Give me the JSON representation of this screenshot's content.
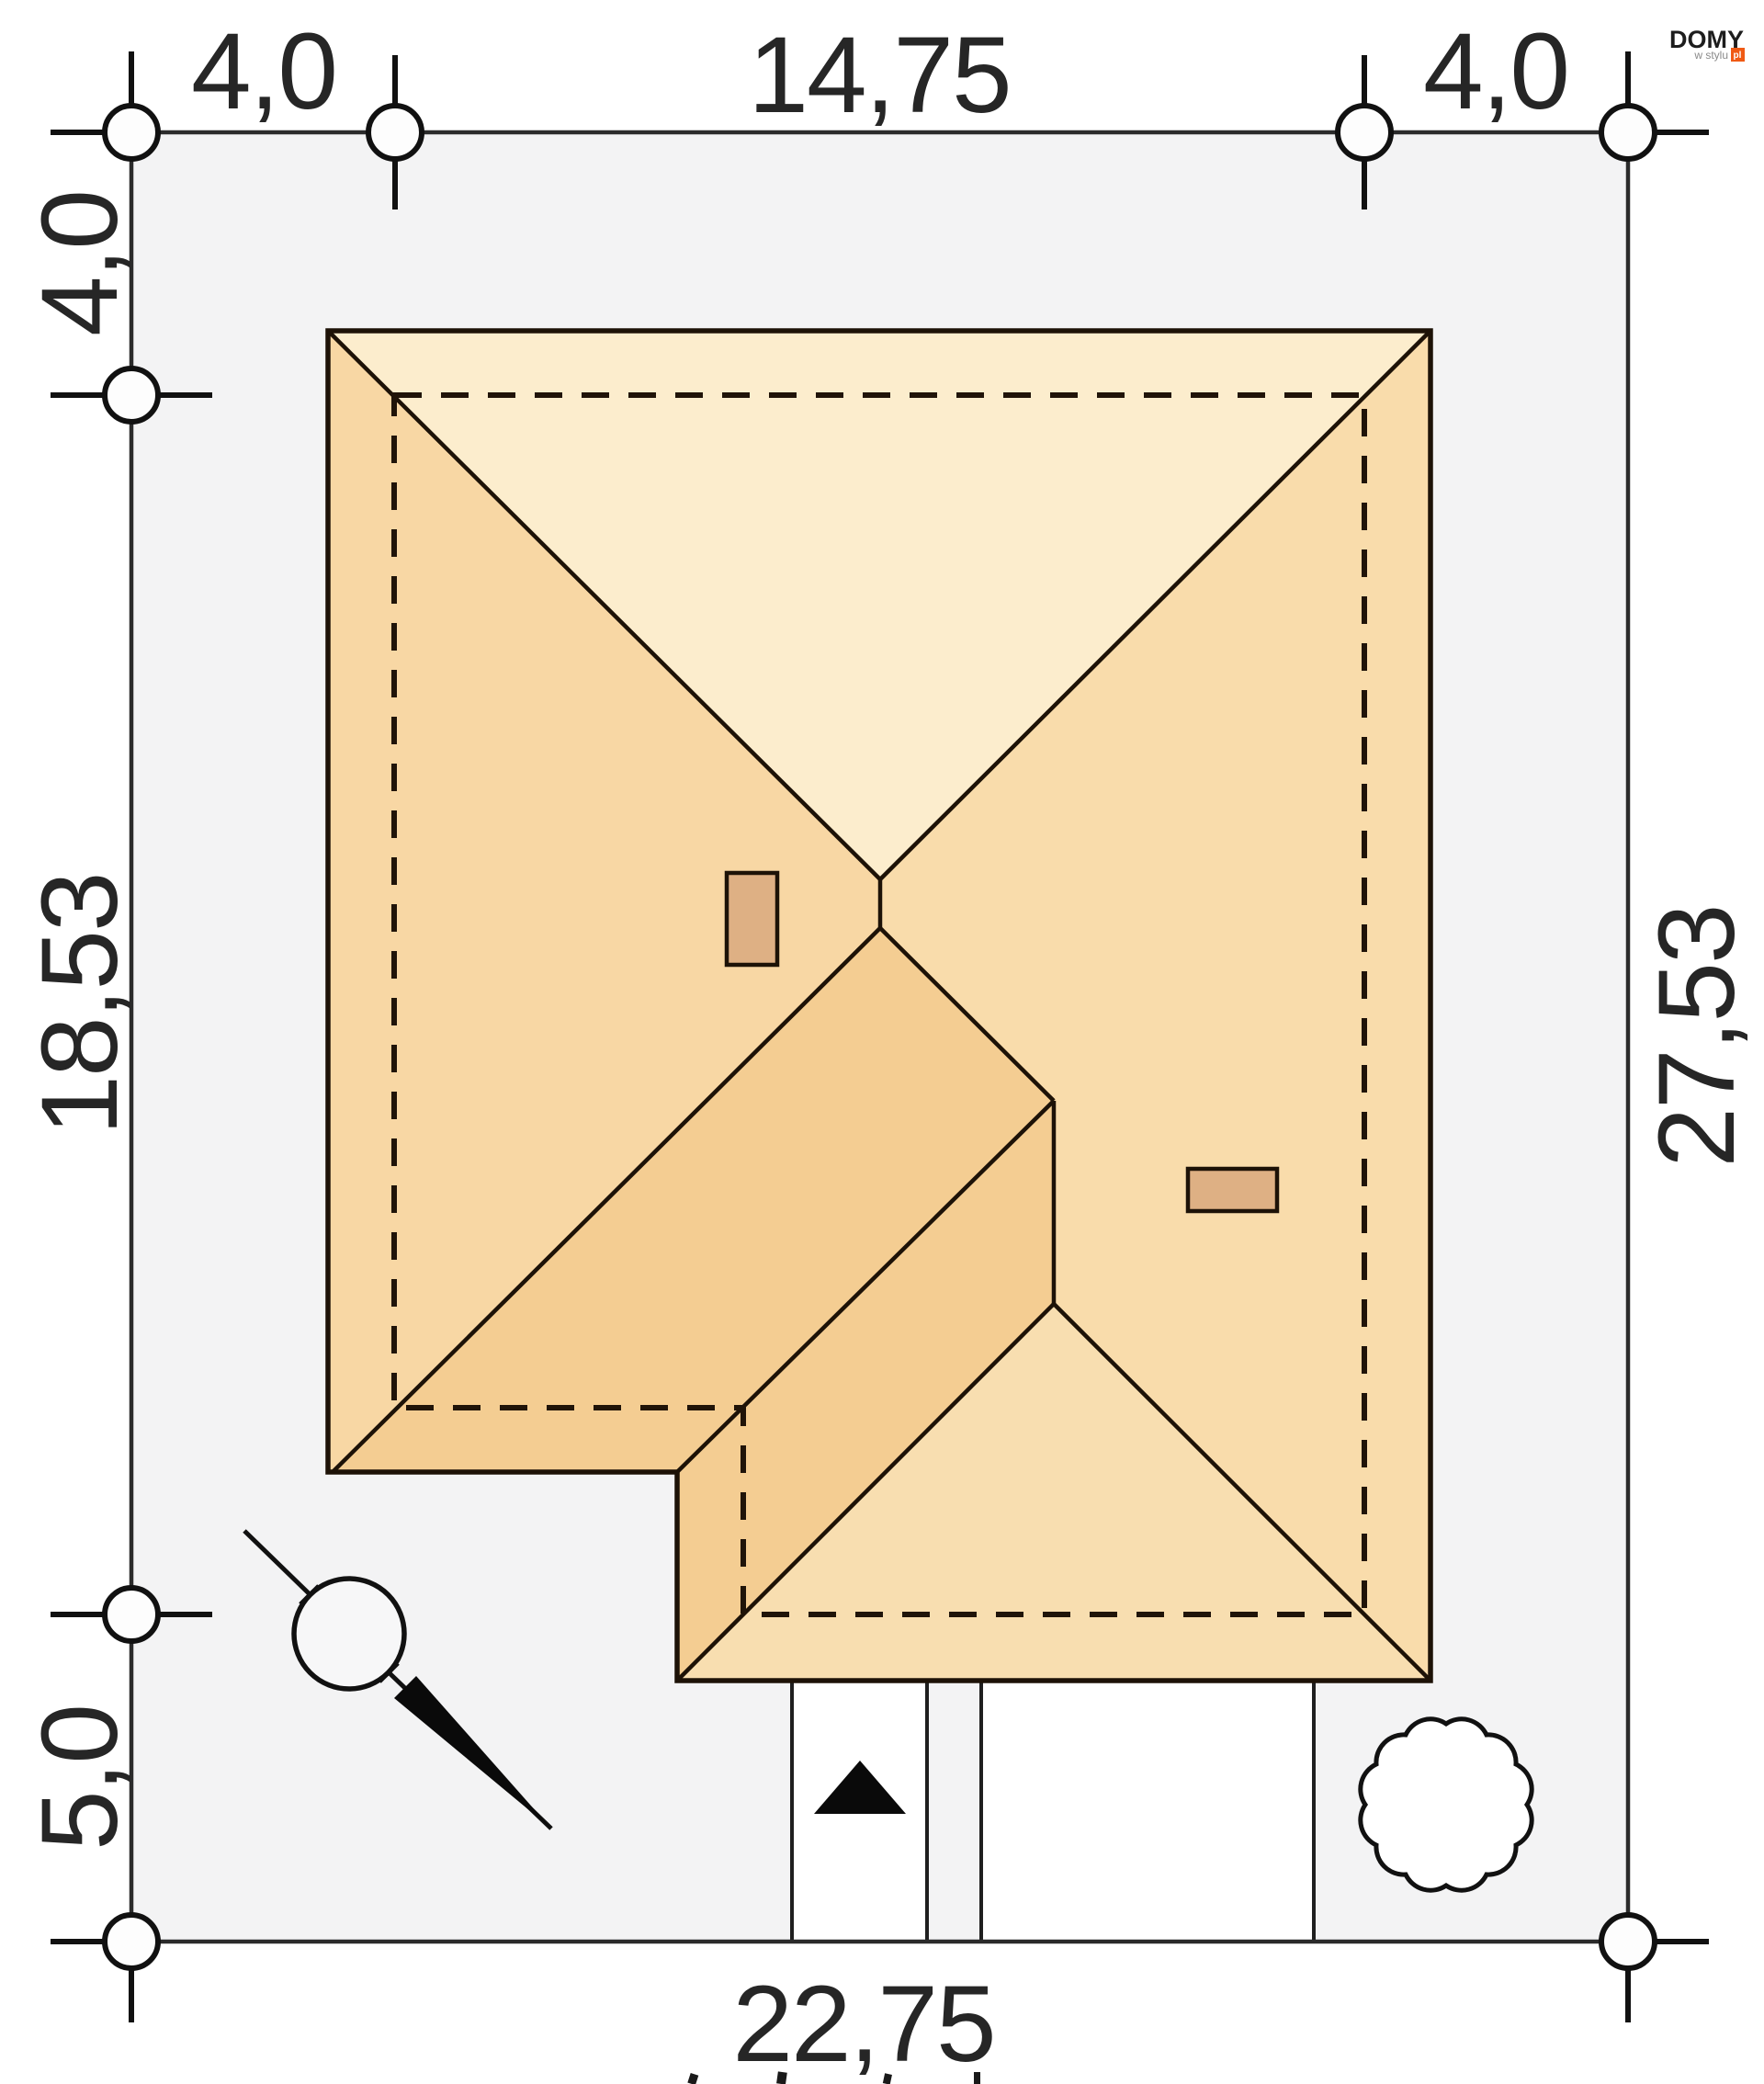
{
  "logo": {
    "brand": "DOMY",
    "sub": "w stylu",
    "tld": "pl"
  },
  "dimensions": {
    "top": [
      "4,0",
      "14,75",
      "4,0"
    ],
    "left": [
      "4,0",
      "18,53",
      "5,0"
    ],
    "right": [
      "27,53"
    ],
    "bottom": [
      "22,75"
    ]
  },
  "site_plan": {
    "plot_width_m": "22,75",
    "plot_depth_m": "27,53",
    "house_width_m": "14,75",
    "house_depth_m": "18,53",
    "setback_left_m": "4,0",
    "setback_top_m": "4,0",
    "setback_right_m": "4,0",
    "setback_bottom_m": "5,0"
  },
  "colors": {
    "plot_fill": "#f3f3f4",
    "roof_north": "#fcedcd",
    "roof_east": "#f9dcab",
    "roof_west": "#f8d7a4",
    "roof_south": "#f4cd92",
    "roof_wing_south": "#f8deb0",
    "chimney_fill": "#deb084",
    "line_dark": "#1d1207",
    "logo_accent": "#f05a14"
  }
}
